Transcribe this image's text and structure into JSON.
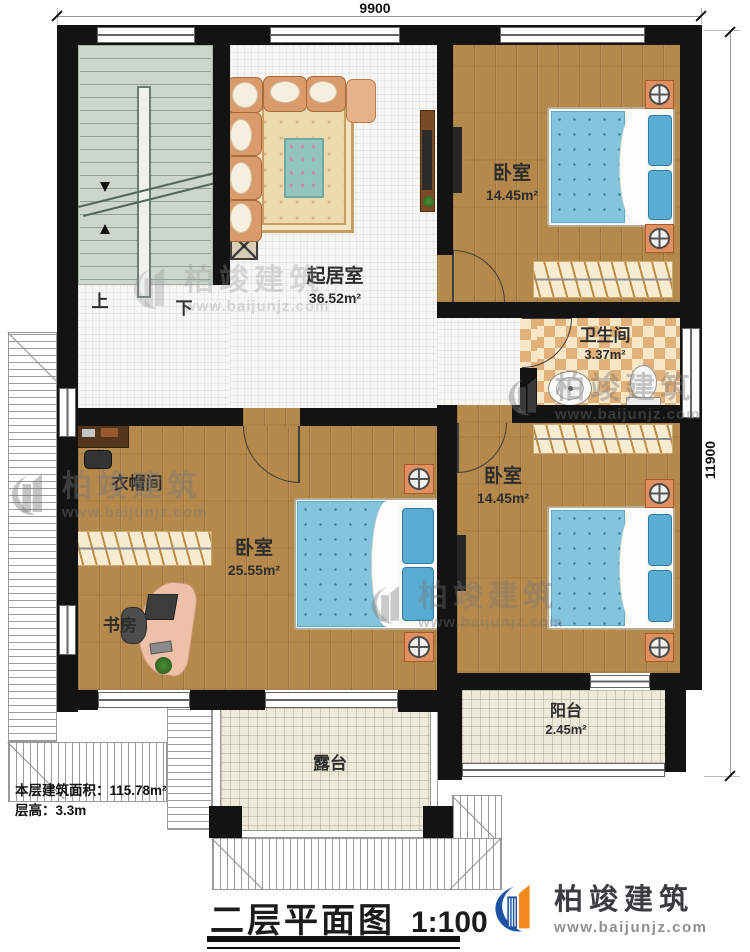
{
  "dimensions": {
    "top": "9900",
    "right": "11900"
  },
  "stairs": {
    "up_label": "上",
    "down_label": "下"
  },
  "rooms": {
    "living_room": {
      "name": "起居室",
      "area": "36.52m²"
    },
    "bedroom_top": {
      "name": "卧室",
      "area": "14.45m²"
    },
    "bathroom": {
      "name": "卫生间",
      "area": "3.37m²"
    },
    "bedroom_right": {
      "name": "卧室",
      "area": "14.45m²"
    },
    "bedroom_main": {
      "name": "卧室",
      "area": "25.55m²"
    },
    "cloakroom": {
      "name": "衣帽间"
    },
    "study": {
      "name": "书房"
    },
    "balcony": {
      "name": "阳台",
      "area": "2.45m²"
    },
    "terrace": {
      "name": "露台"
    }
  },
  "notes": {
    "floor_area": "本层建筑面积：115.78m²",
    "floor_height": "层高：3.3m"
  },
  "titleblock": {
    "title": "二层平面图",
    "scale": "1:100"
  },
  "brand": {
    "name": "柏竣建筑",
    "url": "www.baijunjz.com"
  },
  "watermark": {
    "name": "柏竣建筑",
    "url": "www.baijunjz.com"
  },
  "colors": {
    "wall": "#131313",
    "wood_floor": "#b5894c",
    "tile_floor": "#f6f6f3",
    "stair_floor": "#ccd6cc",
    "bath_tile_dark": "#e2b179",
    "bath_tile_light": "#f7e7c6",
    "terrace_floor": "#edead9",
    "bed_blue": "#84c5de",
    "pillow_blue": "#58acd2",
    "nightstand_orange": "#e08f60",
    "sofa_tan": "#d99a6c",
    "brand_blue": "#1c54a3",
    "brand_orange": "#f28a1e"
  }
}
